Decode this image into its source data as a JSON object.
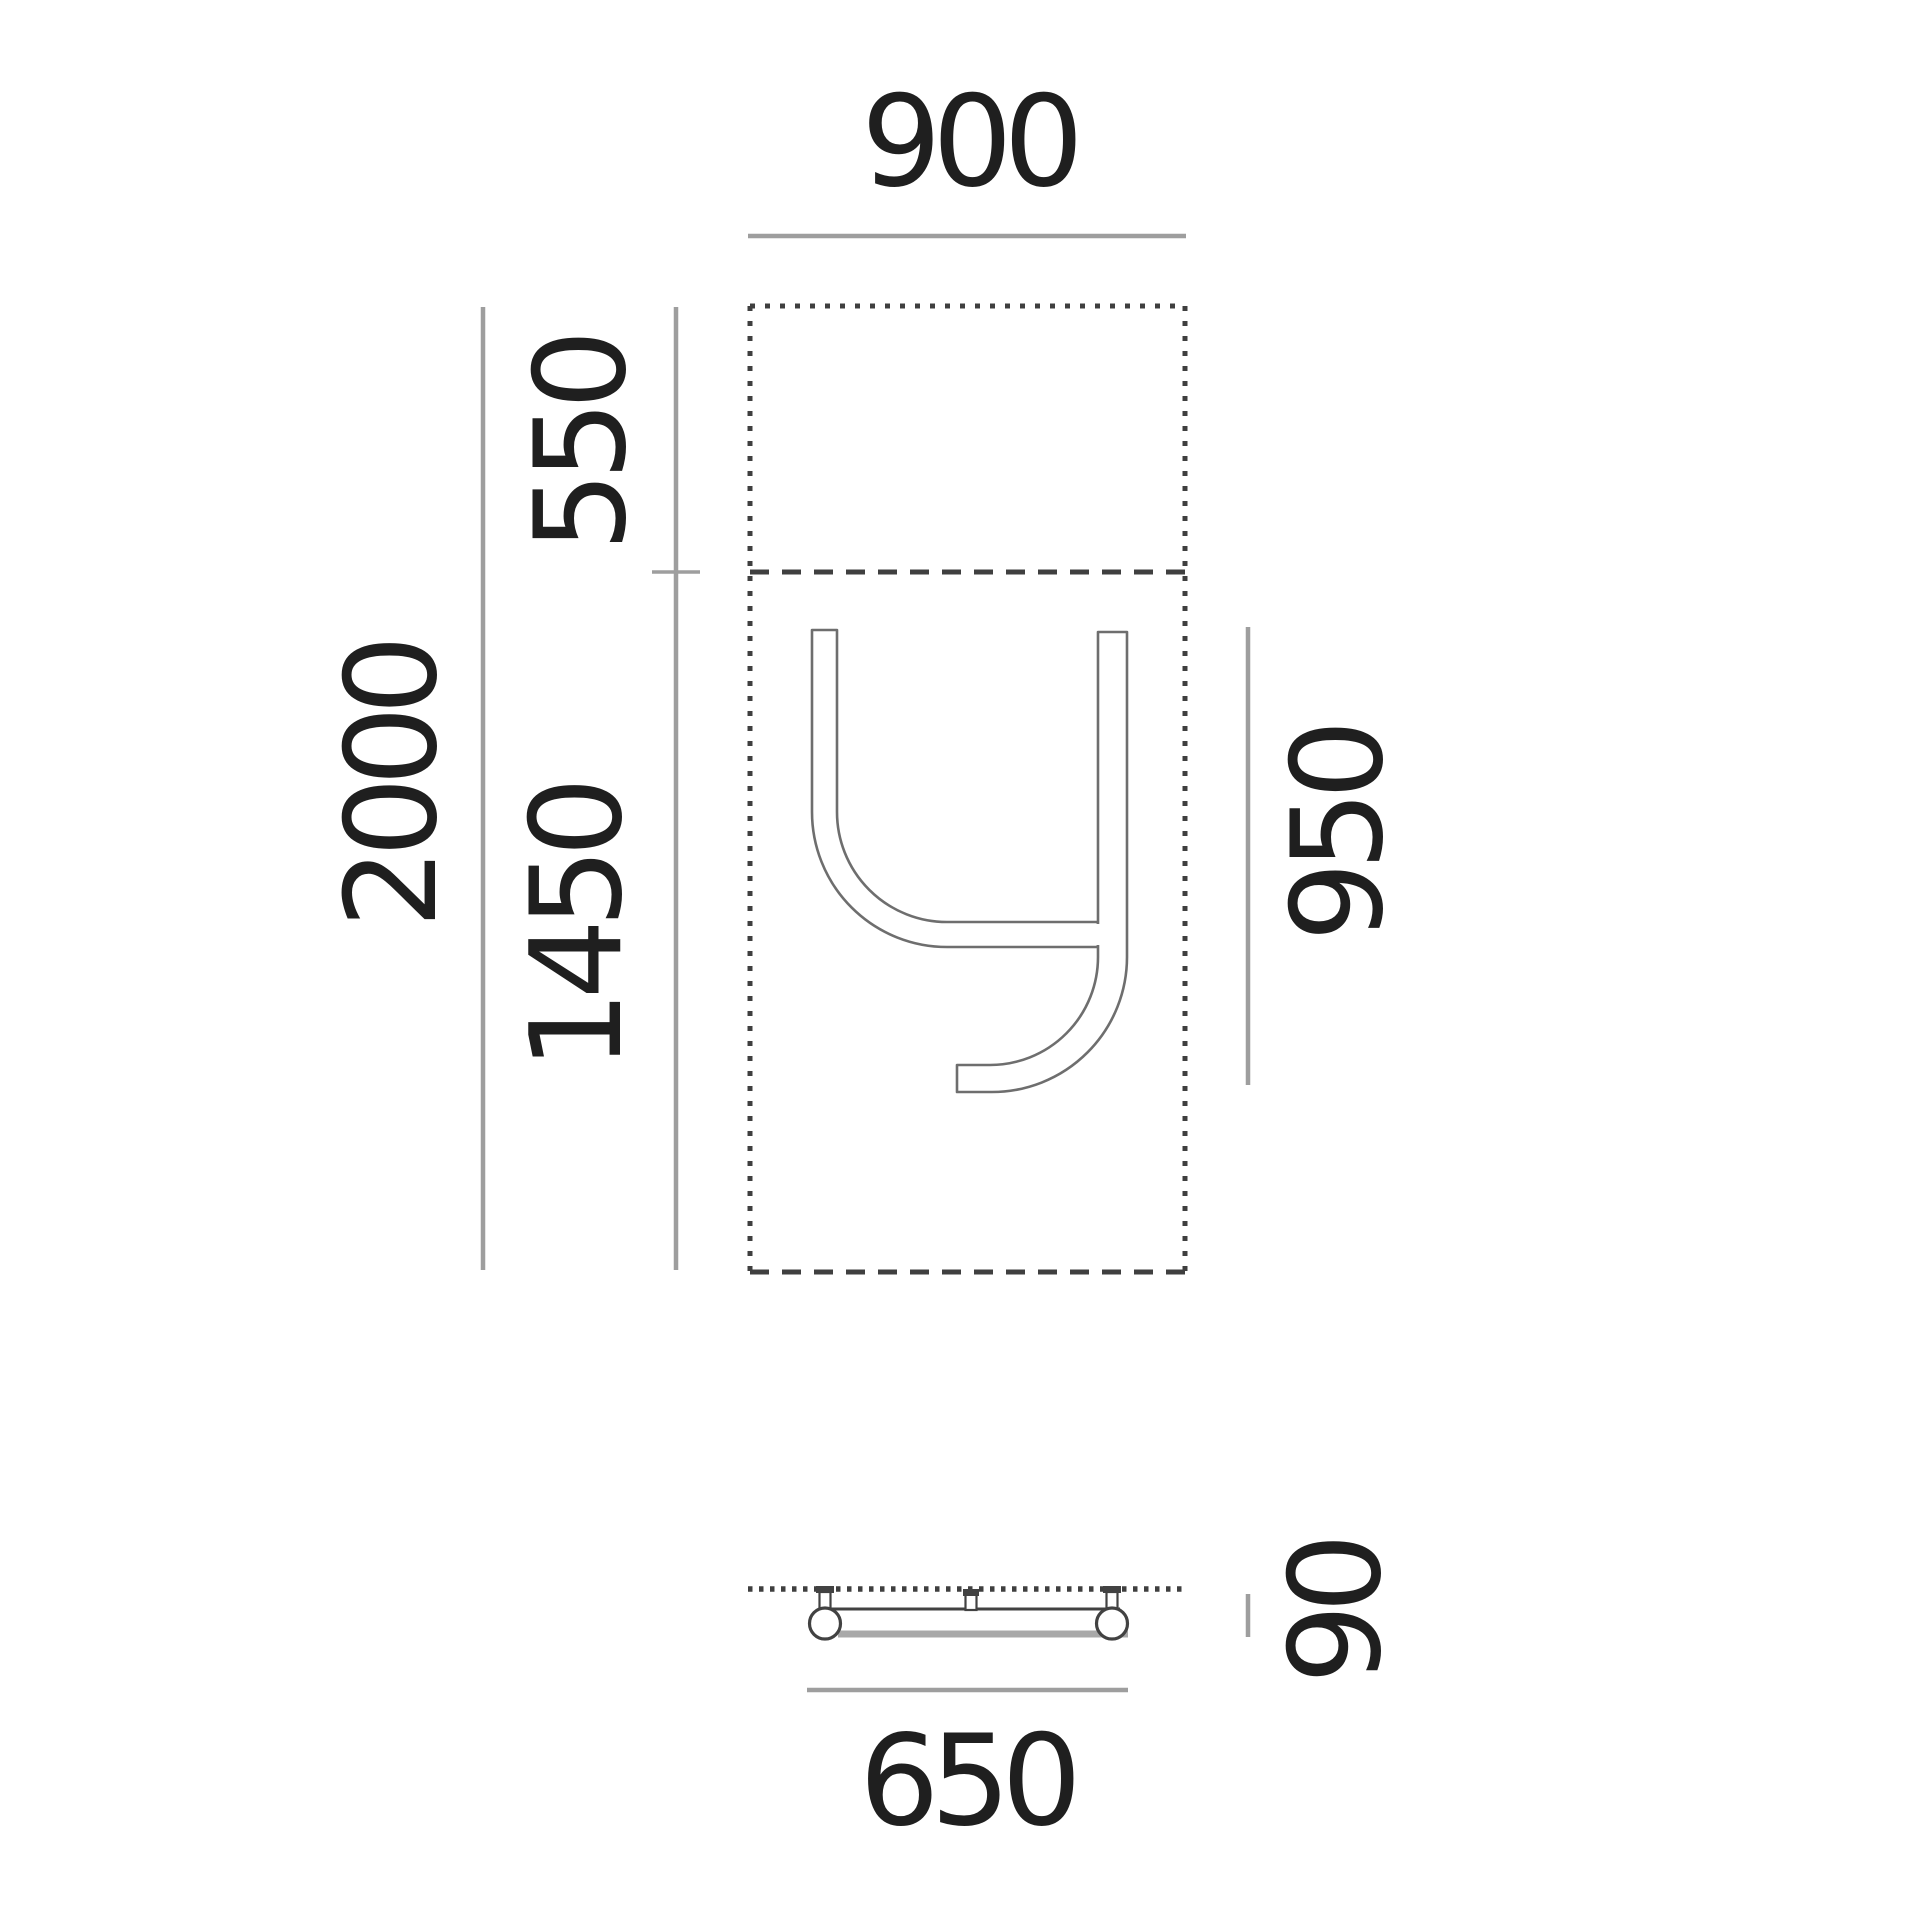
{
  "front_view": {
    "width": "900",
    "overall_height": "2000",
    "top_section_height": "550",
    "lower_section_height": "1450",
    "letter_height": "950"
  },
  "bottom_view": {
    "base_length": "650",
    "base_depth": "90"
  },
  "colors": {
    "background": "#ffffff",
    "dimension_line": "#9e9e9e",
    "dashed_outline": "#3f3f3f",
    "letter_outline": "#6e6e6e",
    "label_text": "#1f1f1f",
    "fixture_dark": "#424242",
    "fixture_shadow": "#a8a8a8"
  }
}
